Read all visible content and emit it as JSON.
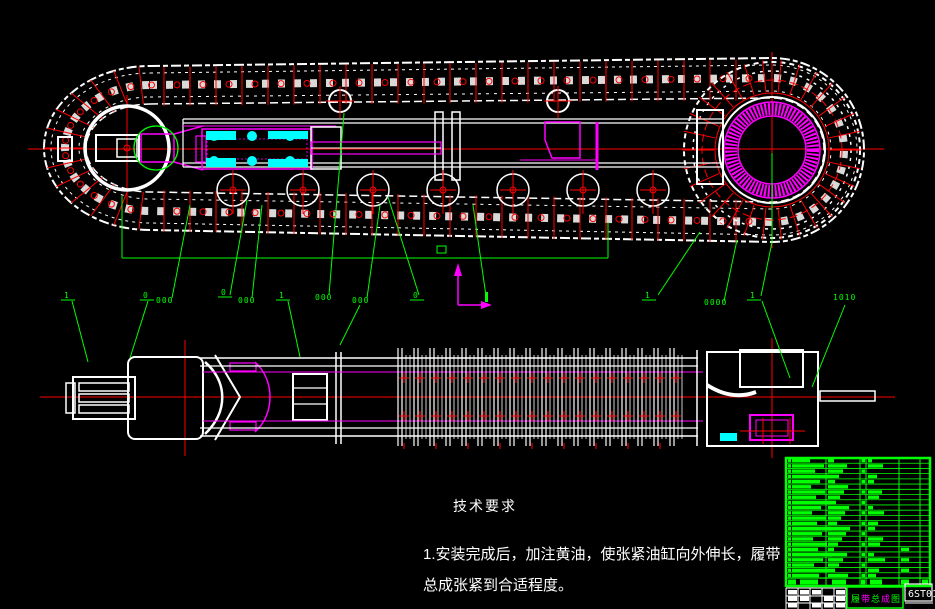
{
  "app": {
    "background": "#000000"
  },
  "colors": {
    "white": "#ffffff",
    "red": "#ff0000",
    "green": "#00ff00",
    "magenta": "#ff00ff",
    "cyan": "#00ffff"
  },
  "notes": {
    "heading": "技术要求",
    "line1": "1.安装完成后，加注黄油，使张紧油缸向外伸长，履带",
    "line2": "总成张紧到合适程度。"
  },
  "title_block": {
    "drawing_title": "履带总成图",
    "drawing_code": "6ST01",
    "bom_rows": 23
  },
  "callouts": [
    {
      "type": "flag",
      "x": 64,
      "y": 298,
      "text": "1"
    },
    {
      "type": "flag",
      "x": 143,
      "y": 298,
      "text": "0"
    },
    {
      "type": "cluster",
      "x": 156,
      "y": 303,
      "text": "000"
    },
    {
      "type": "flag",
      "x": 221,
      "y": 295,
      "text": "0"
    },
    {
      "type": "cluster",
      "x": 238,
      "y": 303,
      "text": "000"
    },
    {
      "type": "flag",
      "x": 279,
      "y": 298,
      "text": "1"
    },
    {
      "type": "cluster",
      "x": 315,
      "y": 300,
      "text": "000"
    },
    {
      "type": "cluster",
      "x": 352,
      "y": 303,
      "text": "000"
    },
    {
      "type": "flag",
      "x": 413,
      "y": 298,
      "text": "0"
    },
    {
      "type": "flag",
      "x": 645,
      "y": 298,
      "text": "1"
    },
    {
      "type": "cluster",
      "x": 704,
      "y": 305,
      "text": "0000"
    },
    {
      "type": "flag",
      "x": 750,
      "y": 298,
      "text": "1"
    },
    {
      "type": "cluster",
      "x": 833,
      "y": 300,
      "text": "1010"
    }
  ]
}
